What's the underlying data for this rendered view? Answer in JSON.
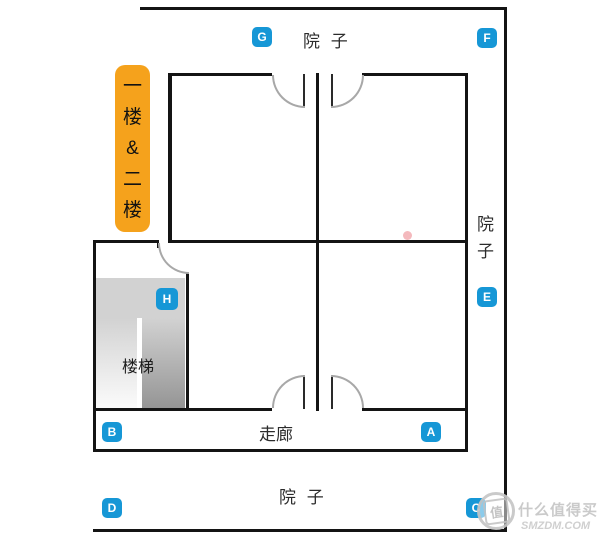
{
  "plan": {
    "floor_label": "一\n楼\n&\n二\n楼",
    "areas": {
      "yard_top": "院 子",
      "yard_right": "院\n子",
      "yard_bottom": "院 子",
      "corridor": "走廊",
      "stairs": "楼梯"
    },
    "markers": {
      "a": "A",
      "b": "B",
      "c": "C",
      "d": "D",
      "e": "E",
      "f": "F",
      "g": "G",
      "h": "H"
    }
  },
  "colors": {
    "marker_blue": "#1697d6",
    "floor_tag_orange": "#f5a21c",
    "wall_black": "#141414",
    "door_arc_gray": "#a8a8a8",
    "stair_gray": "#d2d2d2",
    "pink_dot": "#f4b9bd",
    "watermark_gray": "#c6c6c6"
  },
  "watermark": {
    "logo_char": "值",
    "site_name": "什么值得买",
    "site_domain": "SMZDM.COM"
  }
}
